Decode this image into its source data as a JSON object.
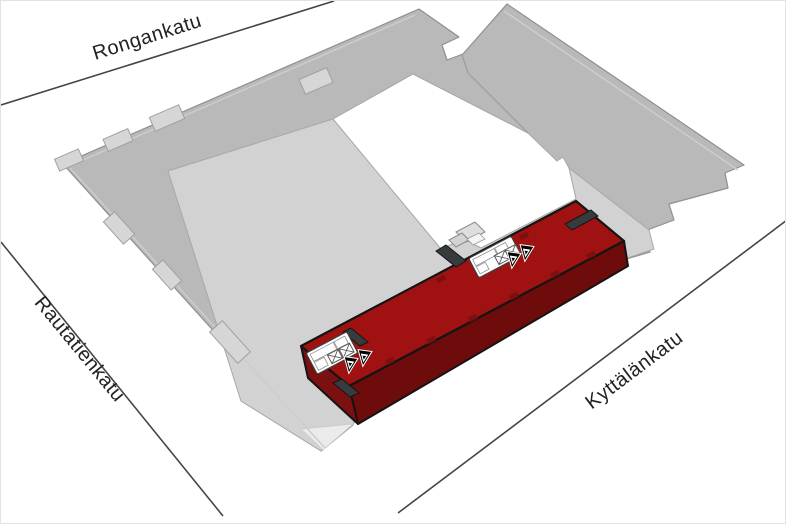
{
  "diagram": {
    "type": "axonometric-site-plan",
    "streets": [
      {
        "id": "rongankatu",
        "name": "Rongankatu"
      },
      {
        "id": "rautatienkatu",
        "name": "Rautatienkatu"
      },
      {
        "id": "kyttalankatu",
        "name": "Kyttälänkatu"
      }
    ],
    "block": {
      "highlighted_buildings": 1,
      "stair_cores": 2,
      "elevator_shafts_per_core": 2,
      "stair_arrows_per_core": 2
    },
    "colors": {
      "background": "#ffffff",
      "block_roof": "#b9b9b9",
      "block_roof_light": "#d2d2d2",
      "block_roof_pale": "#ebebeb",
      "courtyard": "#ffffff",
      "highlight_top": "#a01212",
      "highlight_side": "#6e0b0b",
      "highlight_end": "#7c0f0f",
      "dark_roof_feature": "#363b3e",
      "outline": "#141414",
      "street_line": "#454545",
      "label_text": "#222222"
    }
  }
}
